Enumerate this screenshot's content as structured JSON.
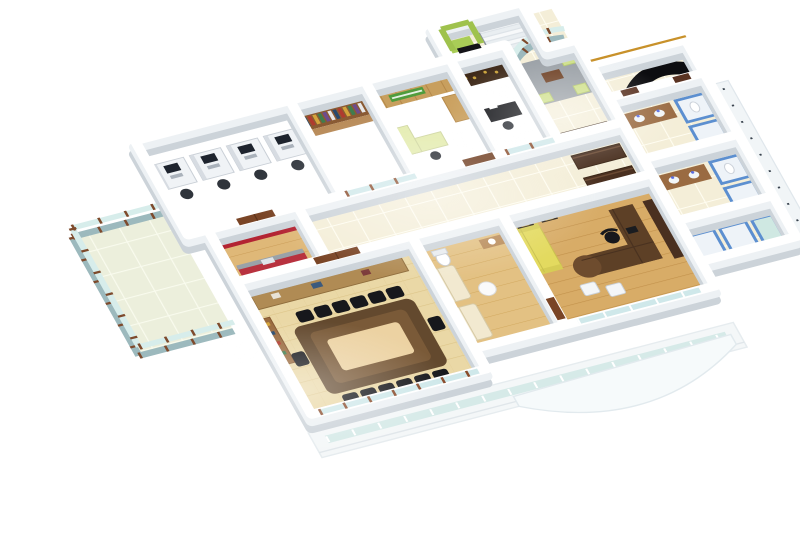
{
  "scene": {
    "title": "3D isometric cutaway render of an office floor plan",
    "background": "#ffffff",
    "view": "isometric-cutaway",
    "rooms": [
      {
        "name": "workstation-area",
        "floor": "cream-tile",
        "items": [
          "4 cubicle desks",
          "computers",
          "task chairs"
        ]
      },
      {
        "name": "library",
        "floor": "cream-tile",
        "items": [
          "wall bookshelf with books",
          "lower cabinet"
        ]
      },
      {
        "name": "manager-cabin",
        "floor": "cream-tile",
        "items": [
          "wood panel wall",
          "green signboard",
          "light green desk"
        ]
      },
      {
        "name": "small-cabin",
        "floor": "cream-tile",
        "items": [
          "dark display cabinet",
          "black desk"
        ]
      },
      {
        "name": "entry-lobby",
        "floor": "cream-tile",
        "items": [
          "green lift",
          "staircase",
          "black entry door"
        ]
      },
      {
        "name": "waiting-area",
        "floor": "cream-tile",
        "items": [
          "gray rug",
          "coffee table",
          "green stools"
        ]
      },
      {
        "name": "reception",
        "floor": "cream-tile",
        "items": [
          "black curved reception desk",
          "gold trim wall"
        ]
      },
      {
        "name": "restrooms",
        "floor": "cream-tile",
        "items": [
          "brown vanity counters",
          "white basins",
          "blue toilet stalls"
        ]
      },
      {
        "name": "wardrobe-bay",
        "floor": "cream-tile",
        "items": [
          "dark wood wardrobes"
        ]
      },
      {
        "name": "pantry",
        "floor": "wood",
        "items": [
          "red wall",
          "red counter with gray top",
          "sink",
          "green water jug"
        ]
      },
      {
        "name": "conference-room",
        "floor": "light-wood",
        "items": [
          "long table with pale inlay",
          "14 black chairs",
          "credenza",
          "book console",
          "framed windows"
        ]
      },
      {
        "name": "lounge",
        "floor": "wood",
        "items": [
          "two cream sofas",
          "round table",
          "toilet",
          "vanity"
        ]
      },
      {
        "name": "md-cabin",
        "floor": "wood-plank",
        "items": [
          "yellow sofa",
          "L-shaped desk",
          "executive chair",
          "2 guest chairs",
          "credenza",
          "wall art",
          "glass front"
        ]
      },
      {
        "name": "balcony",
        "floor": "pale-tile",
        "items": [
          "glass railing with wood posts"
        ]
      },
      {
        "name": "front-facade",
        "items": [
          "white parapet",
          "glass band",
          "curved canopy"
        ]
      }
    ]
  },
  "palette": {
    "wall_white": "#ffffff",
    "wall_shadow": "#ccd3d9",
    "glass": "#d7edeb",
    "frame_wood": "#8a4b2b",
    "red_pantry": "#b32433",
    "counter_red": "#b8323f",
    "counter_gray": "#9aa2a8",
    "green_lift": "#a9cd57",
    "green_seat": "#cfe08a",
    "green_sign": "#4f9c3c",
    "jug_green": "#7fc13d",
    "yellow_sofa": "#e3da5f",
    "cream_sofa": "#f2e9d0",
    "rug_gray": "#9aa0a6",
    "table_dark": "#63492e",
    "table_inlay": "#ecd2a2",
    "chair_black": "#17181c",
    "monitor_dark": "#1e242e",
    "blue_stall": "#5c8fd0",
    "vanity_brown": "#9a6b42",
    "wardrobe_dark": "#4a3020",
    "reception_black": "#0d0d10",
    "gold_trim": "#c8912a",
    "credenza_wood": "#b08b54",
    "shelf_wood": "#8a5a33",
    "cabinet_dark": "#3f2a1a",
    "desk_dark_wood": "#5d4026",
    "door_wood": "#7a4526",
    "lift_door_black": "#141418",
    "desk_green": "#e4ecb0",
    "wood_panel": "#c89f5e"
  }
}
